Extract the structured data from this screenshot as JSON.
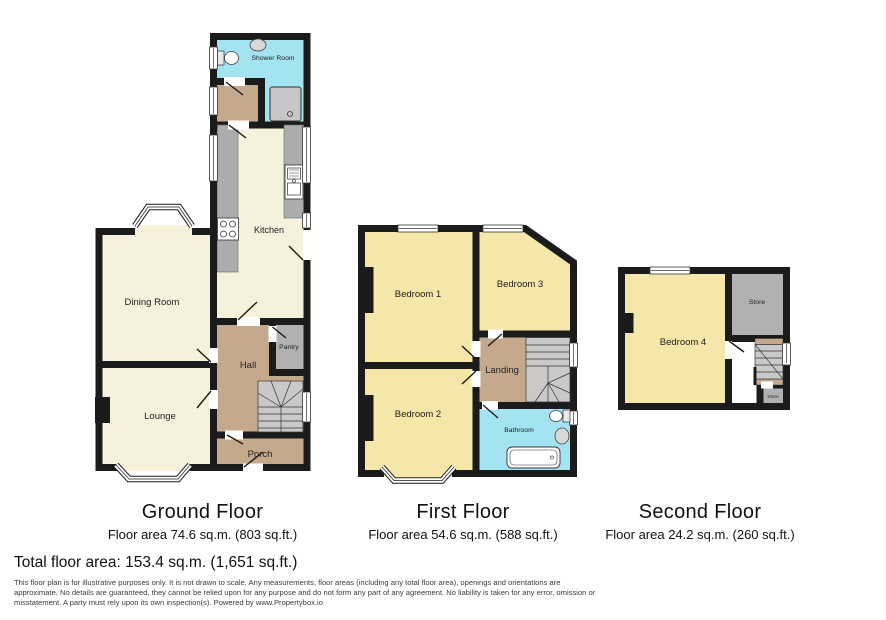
{
  "colors": {
    "wall": "#1b1b1b",
    "cream": "#f6f1dc",
    "bedroom_yellow": "#f5e6a9",
    "tan": "#c5a98c",
    "wet_cyan": "#a3e3f2",
    "storage_grey": "#b1b1b1",
    "stair_grey": "#c9c9c9",
    "counter_grey": "#acacac",
    "fixture_grey": "#c6c6c6",
    "white": "#ffffff"
  },
  "floors": [
    {
      "name": "Ground Floor",
      "area": "Floor area 74.6 sq.m. (803 sq.ft.)",
      "rooms": {
        "shower_room": "Shower Room",
        "kitchen": "Kitchen",
        "dining_room": "Dining Room",
        "hall": "Hall",
        "pantry": "Pantry",
        "lounge": "Lounge",
        "porch": "Porch"
      }
    },
    {
      "name": "First Floor",
      "area": "Floor area 54.6 sq.m. (588 sq.ft.)",
      "rooms": {
        "bedroom_1": "Bedroom 1",
        "bedroom_3": "Bedroom 3",
        "bedroom_2": "Bedroom 2",
        "landing": "Landing",
        "bathroom": "Bathroom"
      }
    },
    {
      "name": "Second Floor",
      "area": "Floor area 24.2 sq.m. (260 sq.ft.)",
      "rooms": {
        "bedroom_4": "Bedroom 4",
        "store": "Store",
        "store_small": "Store"
      }
    }
  ],
  "total_area_label": "Total floor area: 153.4 sq.m. (1,651 sq.ft.)",
  "disclaimer_lines": [
    "This floor plan is for illustrative purposes only. It is not drawn to scale. Any measurements, floor areas (including any total floor area), openings and orientations are",
    "approximate. No details are guaranteed, they cannot be relied upon for any purpose and do not form any part of any agreement. No liability is taken for any error, omission or",
    "misstatement. A party must rely upon its own inspection(s). Powered by www.Propertybox.io"
  ]
}
